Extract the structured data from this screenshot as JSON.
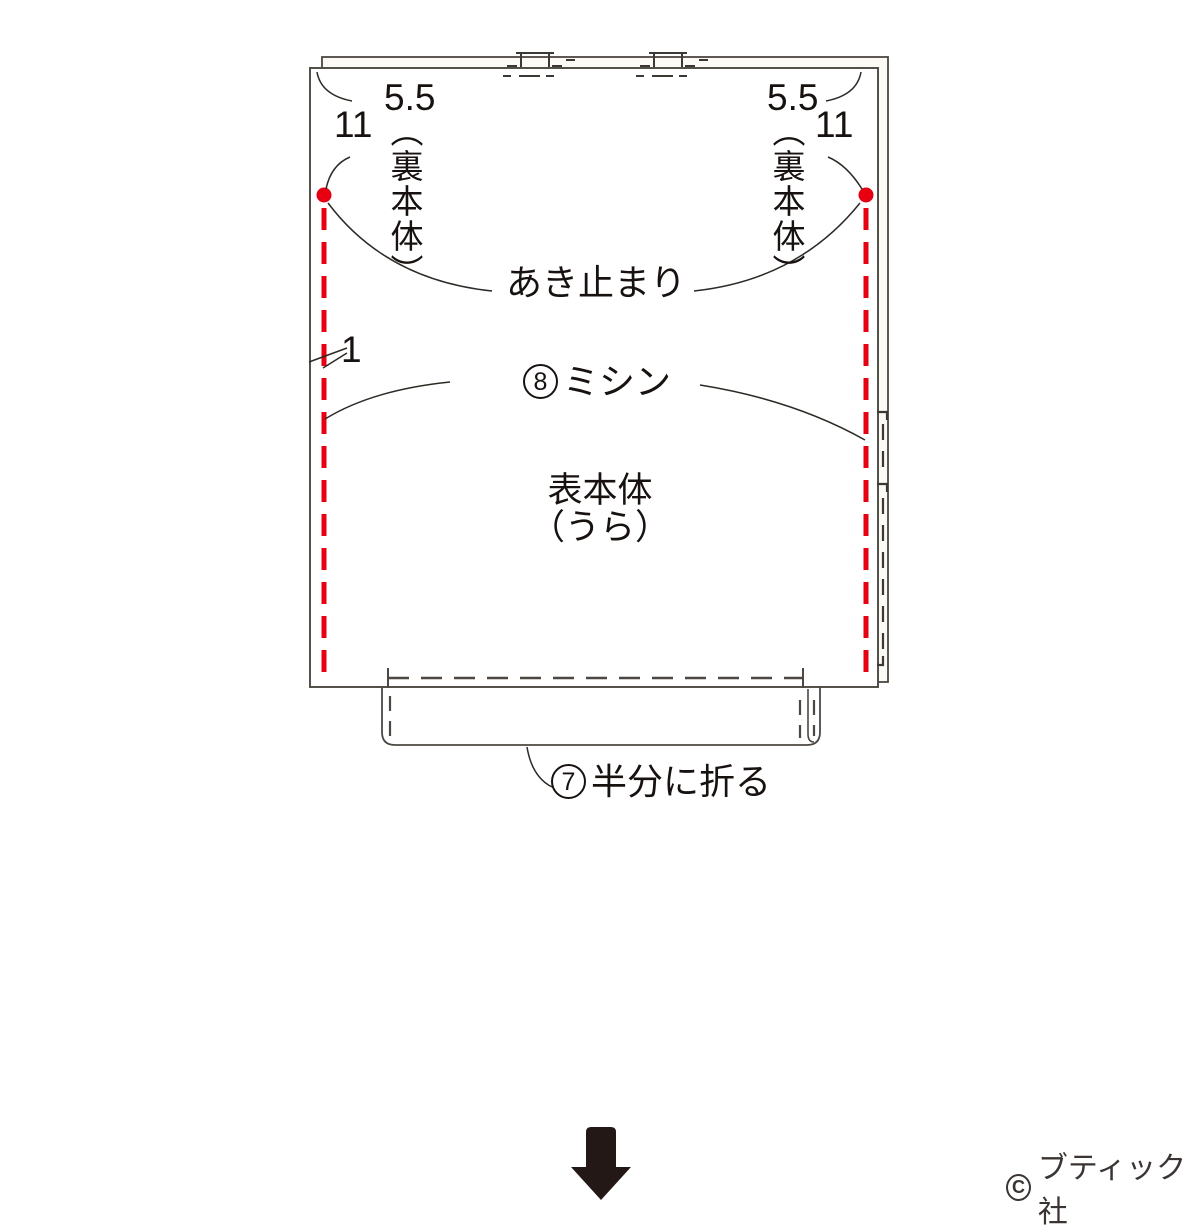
{
  "colors": {
    "accent_red": "#e60012",
    "line_dark": "#4c4741",
    "text": "#17120f",
    "arrow_black": "#231815",
    "lining_fill": "#fbfaf4"
  },
  "labels": {
    "left": {
      "lining_dim": "5.5",
      "lining_name": "（裏本体）",
      "body_dim": "11"
    },
    "right": {
      "lining_dim": "5.5",
      "lining_name": "（裏本体）",
      "body_dim": "11"
    },
    "seam_allowance": "1",
    "opening_stop": "あき止まり",
    "step8": {
      "number": "8",
      "text": "ミシン"
    },
    "body_name_line1": "表本体",
    "body_name_line2": "（うら）",
    "step7": {
      "number": "7",
      "text": "半分に折る"
    },
    "copyright": {
      "symbol": "C",
      "publisher": "ブティック社"
    }
  }
}
